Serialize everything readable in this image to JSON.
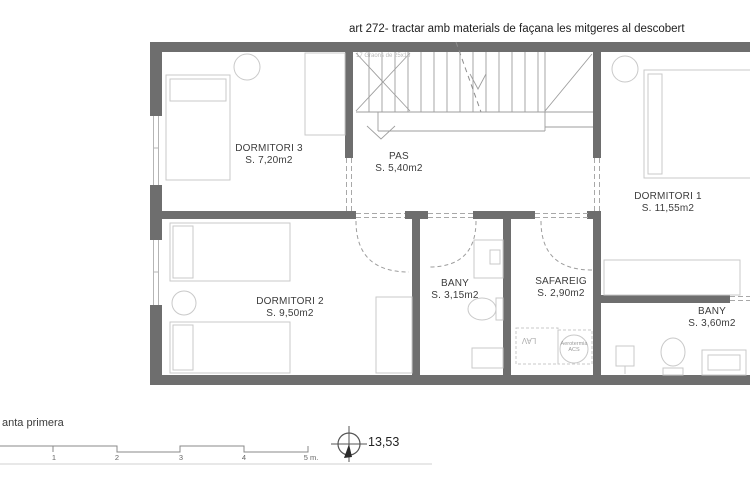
{
  "header": {
    "note": "art 272- tractar amb materials de façana les mitgeres al descobert"
  },
  "plan": {
    "rooms": [
      {
        "name": "DORMITORI 3",
        "area": "S. 7,20m2"
      },
      {
        "name": "PAS",
        "area": "S. 5,40m2"
      },
      {
        "name": "DORMITORI 1",
        "area": "S. 11,55m2"
      },
      {
        "name": "DORMITORI 2",
        "area": "S. 9,50m2"
      },
      {
        "name": "BANY",
        "area": "S. 3,15m2"
      },
      {
        "name": "SAFAREIG",
        "area": "S. 2,90m2"
      },
      {
        "name": "BANY",
        "area": "S. 3,60m2"
      }
    ],
    "stair_note": "17 Graons de 25x18",
    "equipment": {
      "lav": "LAV",
      "acs_line1": "Aerotermia",
      "acs_line2": "ACS"
    }
  },
  "footer": {
    "plan_title": "anta primera",
    "scale_ticks": [
      "1",
      "2",
      "3",
      "4",
      "5 m."
    ],
    "north_value": "13,53"
  },
  "colors": {
    "wall": "#6e6e6e",
    "fixture_line": "#c9c9c9",
    "stair_line": "#9d9d9d",
    "text": "#3c3c3c"
  }
}
